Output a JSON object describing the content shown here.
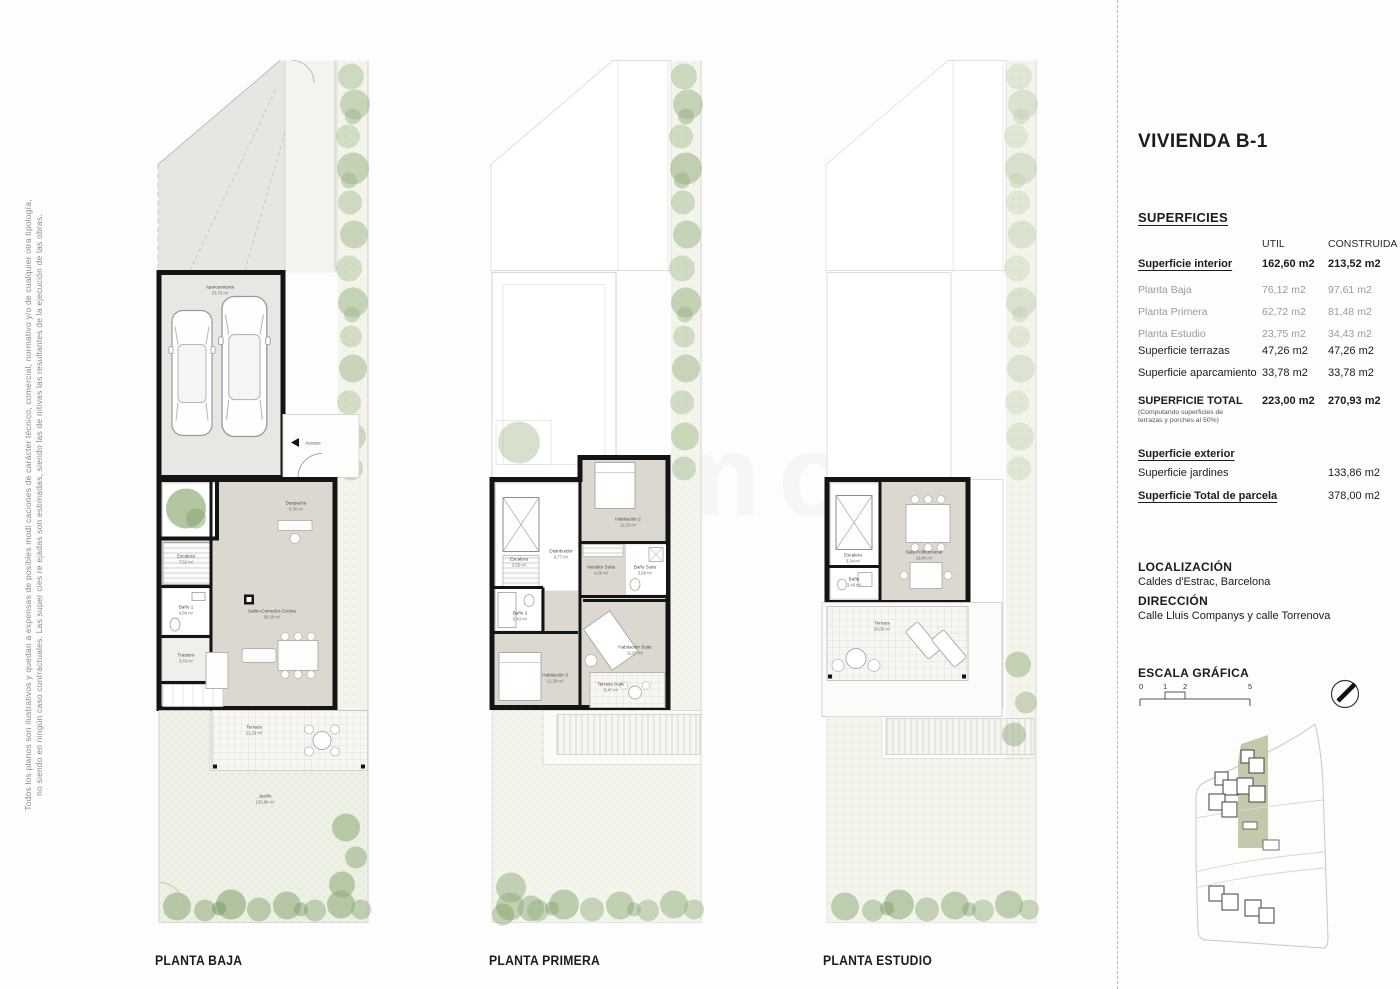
{
  "page": {
    "disclaimer_line1": "Todos los planos son ilustrativos y quedan a expensas de posibles modi caciones de carácter técnico, comercial, normativo y/o de cualquier otra tipología,",
    "disclaimer_line2": "no siendo en ningún caso contractuales. Las super cies re ejadas son estimadas, siendo las de nitivas las resultantes de la ejecución de las obras.",
    "watermark": "inmo"
  },
  "plans": {
    "baja": {
      "label": "PLANTA BAJA",
      "rooms": {
        "aparcamiento": {
          "name": "Aparcamiento",
          "area": "33,78 m²"
        },
        "acceso": {
          "name": "Acceso"
        },
        "escalera": {
          "name": "Escalera",
          "area": "7,52 m²"
        },
        "despacho": {
          "name": "Despacho",
          "area": "8,36 m²"
        },
        "bano1": {
          "name": "Baño 1",
          "area": "4,84 m²"
        },
        "trastero": {
          "name": "Trastero",
          "area": "3,63 m²"
        },
        "salon": {
          "name": "Salón-Comedor-Cocina",
          "area": "58,39 m²"
        },
        "terraza": {
          "name": "Terraza",
          "area": "21,26 m²"
        },
        "jardin": {
          "name": "Jardín",
          "area": "133,86 m²"
        }
      }
    },
    "primera": {
      "label": "PLANTA PRIMERA",
      "rooms": {
        "escalera": {
          "name": "Escalera",
          "area": "3,55 m²"
        },
        "distribuidor": {
          "name": "Distribuidor",
          "area": "6,77 m²"
        },
        "habitacion2": {
          "name": "Habitación 2",
          "area": "11,33 m²"
        },
        "bano2": {
          "name": "Baño 2",
          "area": "5,43 m²"
        },
        "vestidor": {
          "name": "Vestidor Suite",
          "area": "4,00 m²"
        },
        "banosuite": {
          "name": "Baño Suite",
          "area": "3,66 m²"
        },
        "habitacion3": {
          "name": "Habitación 3",
          "area": "12,39 m²"
        },
        "habitacionsuite": {
          "name": "Habitación Suite",
          "area": "11,87 m²"
        },
        "terrazasuite": {
          "name": "Terraza Suite",
          "area": "5,47 m²"
        }
      }
    },
    "estudio": {
      "label": "PLANTA ESTUDIO",
      "rooms": {
        "escalera": {
          "name": "Escalera",
          "area": "3,34 m²"
        },
        "sala": {
          "name": "Sala Polifuncional",
          "area": "19,84 m²"
        },
        "bano3": {
          "name": "Baño",
          "area": "3,46 m²"
        },
        "terraza": {
          "name": "Terraza",
          "area": "20,06 m²"
        }
      }
    }
  },
  "panel": {
    "title": "VIVIENDA B-1",
    "superficies_heading": "SUPERFICIES",
    "table": {
      "col_util": "UTIL",
      "col_construida": "CONSTRUIDA",
      "rows": [
        {
          "label": "Superficie interior",
          "util": "162,60 m2",
          "construida": "213,52 m2"
        },
        {
          "label": "Planta Baja",
          "util": "76,12 m2",
          "construida": "97,61 m2"
        },
        {
          "label": "Planta Primera",
          "util": "62,72 m2",
          "construida": "81,48 m2"
        },
        {
          "label": "Planta Estudio",
          "util": "23,75 m2",
          "construida": "34,43 m2"
        },
        {
          "label": "Superficie terrazas",
          "util": "47,26 m2",
          "construida": "47,26 m2"
        },
        {
          "label": "Superficie aparcamiento",
          "util": "33,78 m2",
          "construida": "33,78 m2"
        }
      ],
      "total": {
        "label": "SUPERFICIE TOTAL",
        "note1": "(Computando superficies de",
        "note2": "terrazas y porches al 50%)",
        "util": "223,00 m2",
        "construida": "270,93 m2"
      }
    },
    "exterior": {
      "heading": "Superficie exterior",
      "jardines_label": "Superficie jardines",
      "jardines_value": "133,86 m2",
      "parcela_label": "Superficie Total de parcela",
      "parcela_value": "378,00 m2"
    },
    "localizacion": {
      "heading": "LOCALIZACIÓN",
      "value": "Caldes d'Estrac, Barcelona"
    },
    "direccion": {
      "heading": "DIRECCIÓN",
      "value": "Calle Lluis Companys y calle Torrenova"
    },
    "escala": {
      "heading": "ESCALA GRÁFICA",
      "t0": "0",
      "t1": "1",
      "t2": "2",
      "t5": "5"
    }
  }
}
